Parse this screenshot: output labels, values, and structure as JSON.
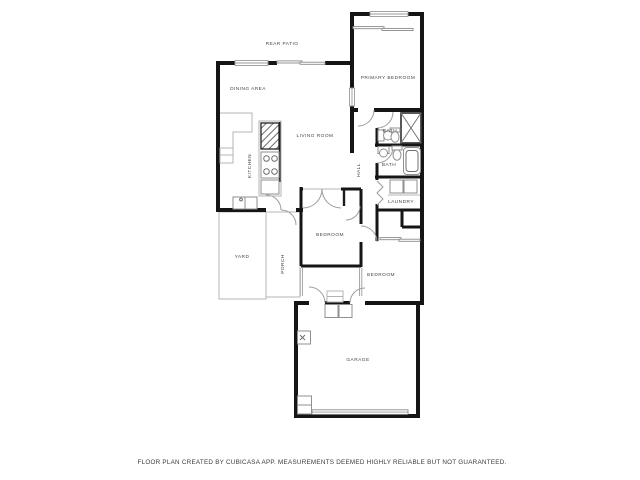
{
  "page": {
    "background": "#ffffff",
    "footer_note": "FLOOR PLAN CREATED BY CUBICASA APP. MEASUREMENTS DEEMED HIGHLY RELIABLE BUT NOT GUARANTEED."
  },
  "floor_plan": {
    "app_name": "CubiCasa",
    "colors": {
      "wall": "#151515",
      "thin_outline": "#b4b4b4",
      "fixture_line": "#8f8f8f",
      "door_arc": "#9d9d9d",
      "label_text": "#474747",
      "floor": "#ffffff"
    },
    "rooms": [
      {
        "name": "rear-patio",
        "label": "REAR PATIO"
      },
      {
        "name": "dining-area",
        "label": "DINING AREA"
      },
      {
        "name": "primary-bedroom",
        "label": "PRIMARY BEDROOM"
      },
      {
        "name": "living-room",
        "label": "LIVING ROOM"
      },
      {
        "name": "kitchen",
        "label": "KITCHEN"
      },
      {
        "name": "bath-upper",
        "label": "BATH"
      },
      {
        "name": "hall",
        "label": "HALL"
      },
      {
        "name": "bath-lower",
        "label": "BATH"
      },
      {
        "name": "laundry",
        "label": "LAUNDRY"
      },
      {
        "name": "bedroom-middle",
        "label": "BEDROOM"
      },
      {
        "name": "yard",
        "label": "YARD"
      },
      {
        "name": "porch",
        "label": "PORCH"
      },
      {
        "name": "bedroom-right",
        "label": "BEDROOM"
      },
      {
        "name": "garage",
        "label": "GARAGE"
      }
    ]
  }
}
